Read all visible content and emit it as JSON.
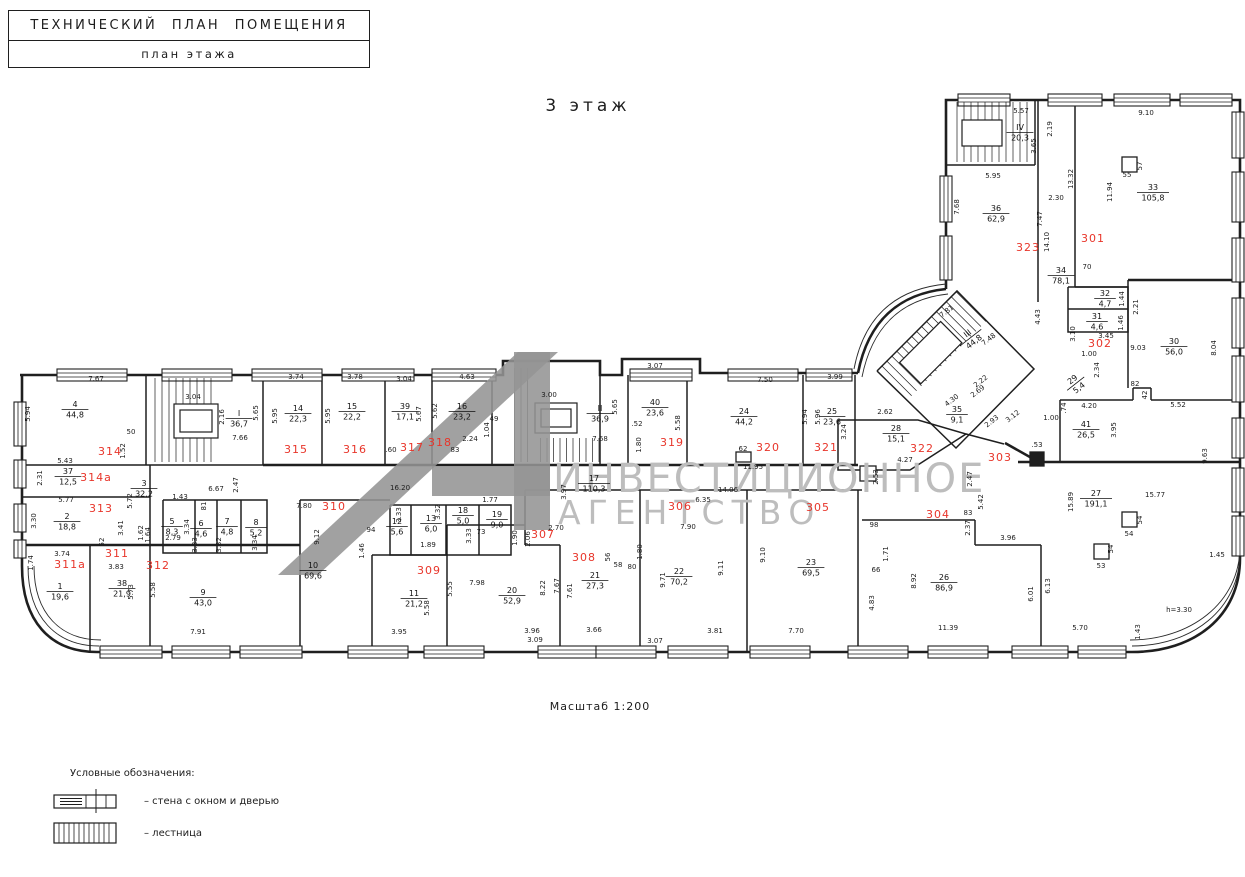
{
  "title_block": {
    "line1": "ТЕХНИЧЕСКИЙ  ПЛАН ПОМЕЩЕНИЯ",
    "line2": "план этажа"
  },
  "floor_title": "3 этаж",
  "scale_label": "Масштаб 1:200",
  "height_note": "h=3.30",
  "watermark": {
    "line1": "ИНВЕСТИЦИОННОЕ",
    "line2": "АГЕНТСТВО",
    "text_color": "#bdbdbd",
    "logo_color": "#949494",
    "polygons": [
      "278,575 318,575 558,352 518,352",
      "514,352 550,352 550,530 514,530",
      "432,466 550,466 550,496 432,496"
    ]
  },
  "legend": {
    "heading": "Условные обозначения:",
    "items": [
      {
        "symbol": "wall-window-door-symbol",
        "label": "– стена с окном и дверью"
      },
      {
        "symbol": "stairs-symbol",
        "label": "– лестница"
      }
    ]
  },
  "colors": {
    "room_number": "#e8352a",
    "line": "#1f1f1f",
    "watermark": "#bdbdbd"
  },
  "room_numbers": [
    [
      "301",
      1093,
      242
    ],
    [
      "302",
      1100,
      347
    ],
    [
      "303",
      1000,
      461
    ],
    [
      "304",
      938,
      518
    ],
    [
      "305",
      818,
      511
    ],
    [
      "306",
      680,
      510
    ],
    [
      "307",
      543,
      538
    ],
    [
      "308",
      584,
      561
    ],
    [
      "309",
      429,
      574
    ],
    [
      "310",
      334,
      510
    ],
    [
      "311",
      117,
      557
    ],
    [
      "311а",
      70,
      568
    ],
    [
      "312",
      158,
      569
    ],
    [
      "313",
      101,
      512
    ],
    [
      "314",
      110,
      455
    ],
    [
      "314а",
      96,
      481
    ],
    [
      "315",
      296,
      453
    ],
    [
      "316",
      355,
      453
    ],
    [
      "317",
      412,
      451
    ],
    [
      "318",
      440,
      446
    ],
    [
      "319",
      672,
      446
    ],
    [
      "320",
      768,
      451
    ],
    [
      "321",
      826,
      451
    ],
    [
      "322",
      922,
      452
    ],
    [
      "323",
      1028,
      251
    ]
  ],
  "room_labels": [
    [
      "4",
      "44,8",
      75,
      410
    ],
    [
      "I",
      "36,7",
      239,
      419
    ],
    [
      "37",
      "12,5",
      68,
      477
    ],
    [
      "3",
      "32,2",
      144,
      489
    ],
    [
      "2",
      "18,8",
      67,
      522
    ],
    [
      "1",
      "19,6",
      60,
      592
    ],
    [
      "38",
      "21,9",
      122,
      589
    ],
    [
      "9",
      "43,0",
      203,
      598
    ],
    [
      "5",
      "8,3",
      172,
      527
    ],
    [
      "6",
      "4,6",
      201,
      529
    ],
    [
      "7",
      "4,8",
      227,
      527
    ],
    [
      "8",
      "5,2",
      256,
      528
    ],
    [
      "14",
      "22,3",
      298,
      414
    ],
    [
      "15",
      "22,2",
      352,
      412
    ],
    [
      "39",
      "17,1",
      405,
      412
    ],
    [
      "16",
      "23,2",
      462,
      412
    ],
    [
      "II",
      "36,9",
      600,
      414
    ],
    [
      "40",
      "23,6",
      655,
      408
    ],
    [
      "24",
      "44,2",
      744,
      417
    ],
    [
      "25",
      "23,6",
      832,
      417
    ],
    [
      "28",
      "15,1",
      896,
      434
    ],
    [
      "35",
      "9,1",
      957,
      415
    ],
    [
      "III",
      "44,8",
      971,
      338,
      -38
    ],
    [
      "IV",
      "20,3",
      1020,
      133
    ],
    [
      "36",
      "62,9",
      996,
      214
    ],
    [
      "33",
      "105,8",
      1153,
      193
    ],
    [
      "34",
      "78,1",
      1061,
      276
    ],
    [
      "32",
      "4,7",
      1105,
      299
    ],
    [
      "31",
      "4,6",
      1097,
      322
    ],
    [
      "29",
      "5,4",
      1076,
      384,
      -38
    ],
    [
      "30",
      "56,0",
      1174,
      347
    ],
    [
      "41",
      "26,5",
      1086,
      430
    ],
    [
      "27",
      "191,1",
      1096,
      499
    ],
    [
      "26",
      "86,9",
      944,
      583
    ],
    [
      "23",
      "69,5",
      811,
      568
    ],
    [
      "22",
      "70,2",
      679,
      577
    ],
    [
      "21",
      "27,3",
      595,
      581
    ],
    [
      "20",
      "52,9",
      512,
      596
    ],
    [
      "11",
      "21,2",
      414,
      599
    ],
    [
      "10",
      "69,6",
      313,
      571
    ],
    [
      "12",
      "5,6",
      397,
      527
    ],
    [
      "13",
      "6,0",
      431,
      524
    ],
    [
      "18",
      "5,0",
      463,
      516
    ],
    [
      "19",
      "9,0",
      497,
      520
    ],
    [
      "17",
      "110,3",
      594,
      484
    ]
  ],
  "dims": [
    [
      "7.67",
      96,
      381
    ],
    [
      "5.94",
      30,
      414,
      -90
    ],
    [
      "3.04",
      193,
      399
    ],
    [
      "7.66",
      240,
      440
    ],
    [
      "50",
      131,
      434
    ],
    [
      "1.52",
      125,
      451,
      -90
    ],
    [
      "2.16",
      224,
      417,
      -90
    ],
    [
      "5.65",
      258,
      413,
      -90
    ],
    [
      "5.95",
      277,
      416,
      -90
    ],
    [
      "3.74",
      296,
      379
    ],
    [
      "3.78",
      355,
      379
    ],
    [
      "5.95",
      330,
      416,
      -90
    ],
    [
      "3.04",
      404,
      381
    ],
    [
      "5.67",
      421,
      414,
      -90
    ],
    [
      "5.62",
      437,
      411,
      -90
    ],
    [
      "4.63",
      467,
      379
    ],
    [
      "2.24",
      470,
      441
    ],
    [
      "1.04",
      489,
      430,
      -90
    ],
    [
      "49",
      494,
      421
    ],
    [
      ".60",
      391,
      452
    ],
    [
      "83",
      455,
      452
    ],
    [
      "3.00",
      549,
      397
    ],
    [
      "5.65",
      617,
      407,
      -90
    ],
    [
      "7.68",
      600,
      441
    ],
    [
      "3.07",
      655,
      368
    ],
    [
      "5.58",
      680,
      423,
      -90
    ],
    [
      ".52",
      637,
      426
    ],
    [
      "1.80",
      641,
      445,
      -90
    ],
    [
      "7.50",
      765,
      382
    ],
    [
      "5.94",
      807,
      417,
      -90
    ],
    [
      "5.96",
      820,
      417,
      -90
    ],
    [
      "3.99",
      835,
      379
    ],
    [
      "62",
      743,
      451
    ],
    [
      "11.95",
      753,
      469
    ],
    [
      "2.62",
      885,
      414
    ],
    [
      "3.24",
      846,
      432,
      -90
    ],
    [
      "4.27",
      905,
      462
    ],
    [
      "5.43",
      65,
      463
    ],
    [
      "2.31",
      42,
      478,
      -90
    ],
    [
      "5.77",
      66,
      502
    ],
    [
      "3.30",
      36,
      521,
      -90
    ],
    [
      "1.74",
      33,
      563,
      -90
    ],
    [
      "3.74",
      62,
      556
    ],
    [
      "3.83",
      116,
      569
    ],
    [
      "3.41",
      123,
      528,
      -90
    ],
    [
      "52",
      104,
      542,
      -90
    ],
    [
      "5.72",
      132,
      501,
      -90
    ],
    [
      "1.43",
      180,
      499
    ],
    [
      "6.67",
      216,
      491
    ],
    [
      "2.47",
      238,
      485,
      -90
    ],
    [
      "81",
      206,
      506,
      -90
    ],
    [
      "2.79",
      173,
      540
    ],
    [
      "3.34",
      189,
      527,
      -90
    ],
    [
      "3.33",
      197,
      545,
      -90
    ],
    [
      "3.32",
      221,
      545,
      -90
    ],
    [
      "3.34",
      257,
      543,
      -90
    ],
    [
      "1.62",
      143,
      533,
      -90
    ],
    [
      "1.64",
      150,
      535,
      -90
    ],
    [
      "7.91",
      198,
      634
    ],
    [
      "5.73",
      133,
      592,
      -90
    ],
    [
      "5.58",
      155,
      590,
      -90
    ],
    [
      "16.20",
      400,
      490
    ],
    [
      "7.80",
      304,
      508
    ],
    [
      "9.12",
      319,
      537,
      -90
    ],
    [
      "94",
      371,
      532
    ],
    [
      "1.46",
      364,
      551,
      -90
    ],
    [
      "1.89",
      428,
      547
    ],
    [
      "3.33",
      401,
      515,
      -90
    ],
    [
      "3.32",
      440,
      512,
      -90
    ],
    [
      "3.33",
      471,
      536,
      -90
    ],
    [
      "73",
      481,
      534
    ],
    [
      "1.77",
      490,
      502
    ],
    [
      "1.90",
      517,
      538,
      -90
    ],
    [
      "2.06",
      530,
      539,
      -90
    ],
    [
      "2.70",
      556,
      530
    ],
    [
      "3.97",
      566,
      492,
      -90
    ],
    [
      "3.95",
      399,
      634
    ],
    [
      "5.55",
      452,
      589,
      -90
    ],
    [
      "5.58",
      429,
      608,
      -90
    ],
    [
      "7.98",
      477,
      585
    ],
    [
      "8.22",
      545,
      588,
      -90
    ],
    [
      "3.96",
      532,
      633
    ],
    [
      "3.09",
      535,
      642
    ],
    [
      "3.66",
      594,
      632
    ],
    [
      "7.67",
      559,
      586,
      -90
    ],
    [
      "7.61",
      572,
      591,
      -90
    ],
    [
      "56",
      610,
      557,
      -90
    ],
    [
      "58",
      618,
      567
    ],
    [
      "80",
      632,
      569
    ],
    [
      "1.80",
      642,
      552,
      -90
    ],
    [
      "14.06",
      728,
      492
    ],
    [
      "6.35",
      703,
      502
    ],
    [
      "7.90",
      688,
      529
    ],
    [
      "9.71",
      665,
      580,
      -90
    ],
    [
      "9.11",
      723,
      568,
      -90
    ],
    [
      "9.10",
      765,
      555,
      -90
    ],
    [
      "3.81",
      715,
      633
    ],
    [
      "3.07",
      655,
      643
    ],
    [
      "7.70",
      796,
      633
    ],
    [
      "2.53",
      878,
      477,
      -90
    ],
    [
      "98",
      874,
      527
    ],
    [
      "1.71",
      888,
      554,
      -90
    ],
    [
      "66",
      876,
      572
    ],
    [
      "4.83",
      874,
      603,
      -90
    ],
    [
      "8.92",
      916,
      581,
      -90
    ],
    [
      "11.39",
      948,
      630
    ],
    [
      "83",
      968,
      515
    ],
    [
      "2.37",
      970,
      528,
      -90
    ],
    [
      "3.96",
      1008,
      540
    ],
    [
      "6.01",
      1033,
      594,
      -90
    ],
    [
      "6.13",
      1050,
      586,
      -90
    ],
    [
      "5.70",
      1080,
      630
    ],
    [
      "1.43",
      1140,
      632,
      -90
    ],
    [
      "1.45",
      1217,
      557
    ],
    [
      "15.77",
      1155,
      497
    ],
    [
      "15.89",
      1073,
      502,
      -90
    ],
    [
      "9.63",
      1207,
      456,
      -90
    ],
    [
      "2.47",
      972,
      479,
      -90
    ],
    [
      "5.42",
      983,
      502,
      -90
    ],
    [
      ".53",
      1037,
      447
    ],
    [
      "2.93",
      993,
      423,
      -38
    ],
    [
      "3.12",
      1014,
      418,
      -38
    ],
    [
      "1.00",
      1051,
      420
    ],
    [
      ".74",
      1066,
      408,
      -90
    ],
    [
      "4.20",
      1089,
      408
    ],
    [
      "3.95",
      1116,
      430,
      -90
    ],
    [
      "5.52",
      1178,
      407
    ],
    [
      "82",
      1135,
      386
    ],
    [
      "42",
      1147,
      395,
      -90
    ],
    [
      "8.04",
      1216,
      348,
      -90
    ],
    [
      "9.03",
      1138,
      350
    ],
    [
      "3.45",
      1106,
      338
    ],
    [
      "1.00",
      1089,
      356
    ],
    [
      "2.34",
      1099,
      370,
      -90
    ],
    [
      "2.21",
      1138,
      307,
      -90
    ],
    [
      "1.44",
      1124,
      299,
      -90
    ],
    [
      "1.46",
      1123,
      323,
      -90
    ],
    [
      "3.10",
      1075,
      334,
      -90
    ],
    [
      "70",
      1087,
      269
    ],
    [
      "5.57",
      1021,
      113
    ],
    [
      "2.19",
      1052,
      129,
      -90
    ],
    [
      "3.65",
      1036,
      146,
      -90
    ],
    [
      "9.10",
      1146,
      115
    ],
    [
      "11.94",
      1112,
      192,
      -90
    ],
    [
      "13.32",
      1073,
      179,
      -90
    ],
    [
      "2.30",
      1056,
      200
    ],
    [
      "7.47",
      1042,
      219,
      -90
    ],
    [
      "14.10",
      1049,
      242,
      -90
    ],
    [
      "7.68",
      959,
      207,
      -90
    ],
    [
      "5.95",
      993,
      178
    ],
    [
      "55",
      1127,
      177
    ],
    [
      "57",
      1142,
      166,
      -90
    ],
    [
      "7.81",
      948,
      313,
      -38
    ],
    [
      "7.48",
      990,
      341,
      -38
    ],
    [
      "4.43",
      1040,
      317,
      -90
    ],
    [
      "2.22",
      982,
      383,
      -38
    ],
    [
      "2.69",
      979,
      393,
      -38
    ],
    [
      "4.30",
      953,
      402,
      -38
    ],
    [
      "54",
      1129,
      536
    ],
    [
      "54",
      1142,
      520,
      -90
    ],
    [
      "53",
      1101,
      568
    ],
    [
      "54",
      1113,
      549,
      -90
    ],
    [
      "h=3.30",
      1179,
      612
    ]
  ],
  "plan": {
    "outer": [
      "M20,375 H503 V361 H600 V375 H622 V359 H700 V373 H858",
      "M858,373 C868,322 898,294 946,289",
      "M946,289 V100 H1240 V558",
      "M1240,558 C1240,617 1194,652 1132,652",
      "M1132,652 H97",
      "M97,652 C50,652 22,621 22,566",
      "M22,566 V375"
    ],
    "glass": [
      "M854,369 C864,317 895,289 946,284",
      "M862,377 C872,327 901,299 948,294",
      "M1240,552 C1240,610 1191,646 1132,646",
      "M1240,546 C1240,604 1189,640 1130,640",
      "M99,646 C57,646 28,618 28,566",
      "M101,640 C61,640 34,614 34,566"
    ],
    "thick": [
      "M22,545 H300",
      "M263,465 H858",
      "M1018,462 H1240",
      "M1128,280 H1240",
      "M1005,443 L1037,461"
    ],
    "inner": [
      "M22,465 H263",
      "M146,375 V465",
      "M263,375 V465",
      "M22,497 H150",
      "M150,465 V545",
      "M90,545 V652",
      "M150,545 V652",
      "M300,500 V652",
      "M163,500 H267 V553 H163 V500",
      "M195,500 V553",
      "M217,500 V553",
      "M241,500 V553",
      "M322,375 V465",
      "M385,375 V465",
      "M432,375 V465",
      "M492,375 V465",
      "M600,375 V465",
      "M628,375 V465",
      "M687,375 V465",
      "M803,375 V465",
      "M855,375 V465",
      "M838,420 V470 H910 L966,434 L918,420 H838",
      "M300,500 H390",
      "M390,505 H511 V555 H390 V505",
      "M411,505 V555",
      "M446,505 V555",
      "M479,505 V555",
      "M372,555 H447",
      "M372,555 V652",
      "M447,525 V652",
      "M447,525 H525",
      "M525,490 V545",
      "M525,545 H560",
      "M560,545 V652",
      "M640,490 V652",
      "M525,490 H640",
      "M640,490 H862",
      "M747,490 V652",
      "M858,490 V652",
      "M862,520 H975",
      "M975,520 V545",
      "M975,545 H1041",
      "M1041,545 V652",
      "M966,434 L1004,444",
      "M1060,400 V462",
      "M1060,400 H1133",
      "M1133,388 V400",
      "M1133,388 H1151",
      "M1151,388 V400",
      "M1151,400 H1240",
      "M1128,280 V388",
      "M1068,287 H1128 V332 H1068 V287",
      "M1068,309 H1128",
      "M1038,100 V302",
      "M946,165 H1035",
      "M1035,100 V165",
      "M1075,100 V287",
      "M1075,287 H1128",
      "M877,371 L957,291 L1034,369 L956,448 L877,371"
    ],
    "windows_h": [
      [
        57,
        369,
        70
      ],
      [
        162,
        369,
        70
      ],
      [
        252,
        369,
        70
      ],
      [
        342,
        369,
        72
      ],
      [
        432,
        369,
        64
      ],
      [
        630,
        369,
        62
      ],
      [
        728,
        369,
        70
      ],
      [
        806,
        369,
        46
      ],
      [
        958,
        94,
        52
      ],
      [
        1048,
        94,
        54
      ],
      [
        1114,
        94,
        56
      ],
      [
        1180,
        94,
        52
      ],
      [
        100,
        646,
        62
      ],
      [
        172,
        646,
        58
      ],
      [
        240,
        646,
        62
      ],
      [
        348,
        646,
        60
      ],
      [
        424,
        646,
        60
      ],
      [
        538,
        646,
        58
      ],
      [
        596,
        646,
        60
      ],
      [
        668,
        646,
        60
      ],
      [
        750,
        646,
        60
      ],
      [
        848,
        646,
        60
      ],
      [
        928,
        646,
        60
      ],
      [
        1012,
        646,
        56
      ],
      [
        1078,
        646,
        48
      ]
    ],
    "windows_v": [
      [
        14,
        402,
        44
      ],
      [
        14,
        460,
        28
      ],
      [
        14,
        504,
        28
      ],
      [
        14,
        540,
        18
      ],
      [
        940,
        176,
        46
      ],
      [
        940,
        236,
        44
      ],
      [
        1232,
        112,
        46
      ],
      [
        1232,
        172,
        50
      ],
      [
        1232,
        238,
        44
      ],
      [
        1232,
        298,
        50
      ],
      [
        1232,
        356,
        46
      ],
      [
        1232,
        418,
        40
      ],
      [
        1232,
        468,
        44
      ],
      [
        1232,
        516,
        40
      ]
    ],
    "stair_hatch": [
      {
        "x": 148,
        "y": 378,
        "w": 70,
        "h": 84,
        "s": 7
      },
      {
        "x": 508,
        "y": 368,
        "w": 26,
        "h": 94,
        "s": 6.5
      },
      {
        "x": 534,
        "y": 438,
        "w": 66,
        "h": 24,
        "s": 6.5
      },
      {
        "x": 950,
        "y": 102,
        "w": 84,
        "h": 60,
        "s": 7
      },
      {
        "x": 0,
        "y": 0,
        "w": 113,
        "h": 42,
        "s": 7,
        "tf": "translate(877,371) rotate(-45)"
      }
    ],
    "boxes": [
      {
        "x": 174,
        "y": 404,
        "w": 44,
        "h": 34
      },
      {
        "x": 180,
        "y": 410,
        "w": 32,
        "h": 22
      },
      {
        "x": 535,
        "y": 403,
        "w": 42,
        "h": 30
      },
      {
        "x": 541,
        "y": 409,
        "w": 30,
        "h": 18
      },
      {
        "x": 962,
        "y": 120,
        "w": 40,
        "h": 26
      },
      {
        "x": 22,
        "y": 10,
        "w": 58,
        "h": 30,
        "tf": "translate(877,371) rotate(-45)"
      }
    ],
    "columns": [
      [
        1122,
        512,
        15,
        15,
        0
      ],
      [
        1094,
        544,
        15,
        15,
        0
      ],
      [
        1122,
        157,
        15,
        15,
        0
      ],
      [
        736,
        452,
        15,
        10,
        0
      ],
      [
        860,
        466,
        16,
        15,
        0
      ],
      [
        1030,
        452,
        14,
        14,
        1
      ]
    ]
  }
}
